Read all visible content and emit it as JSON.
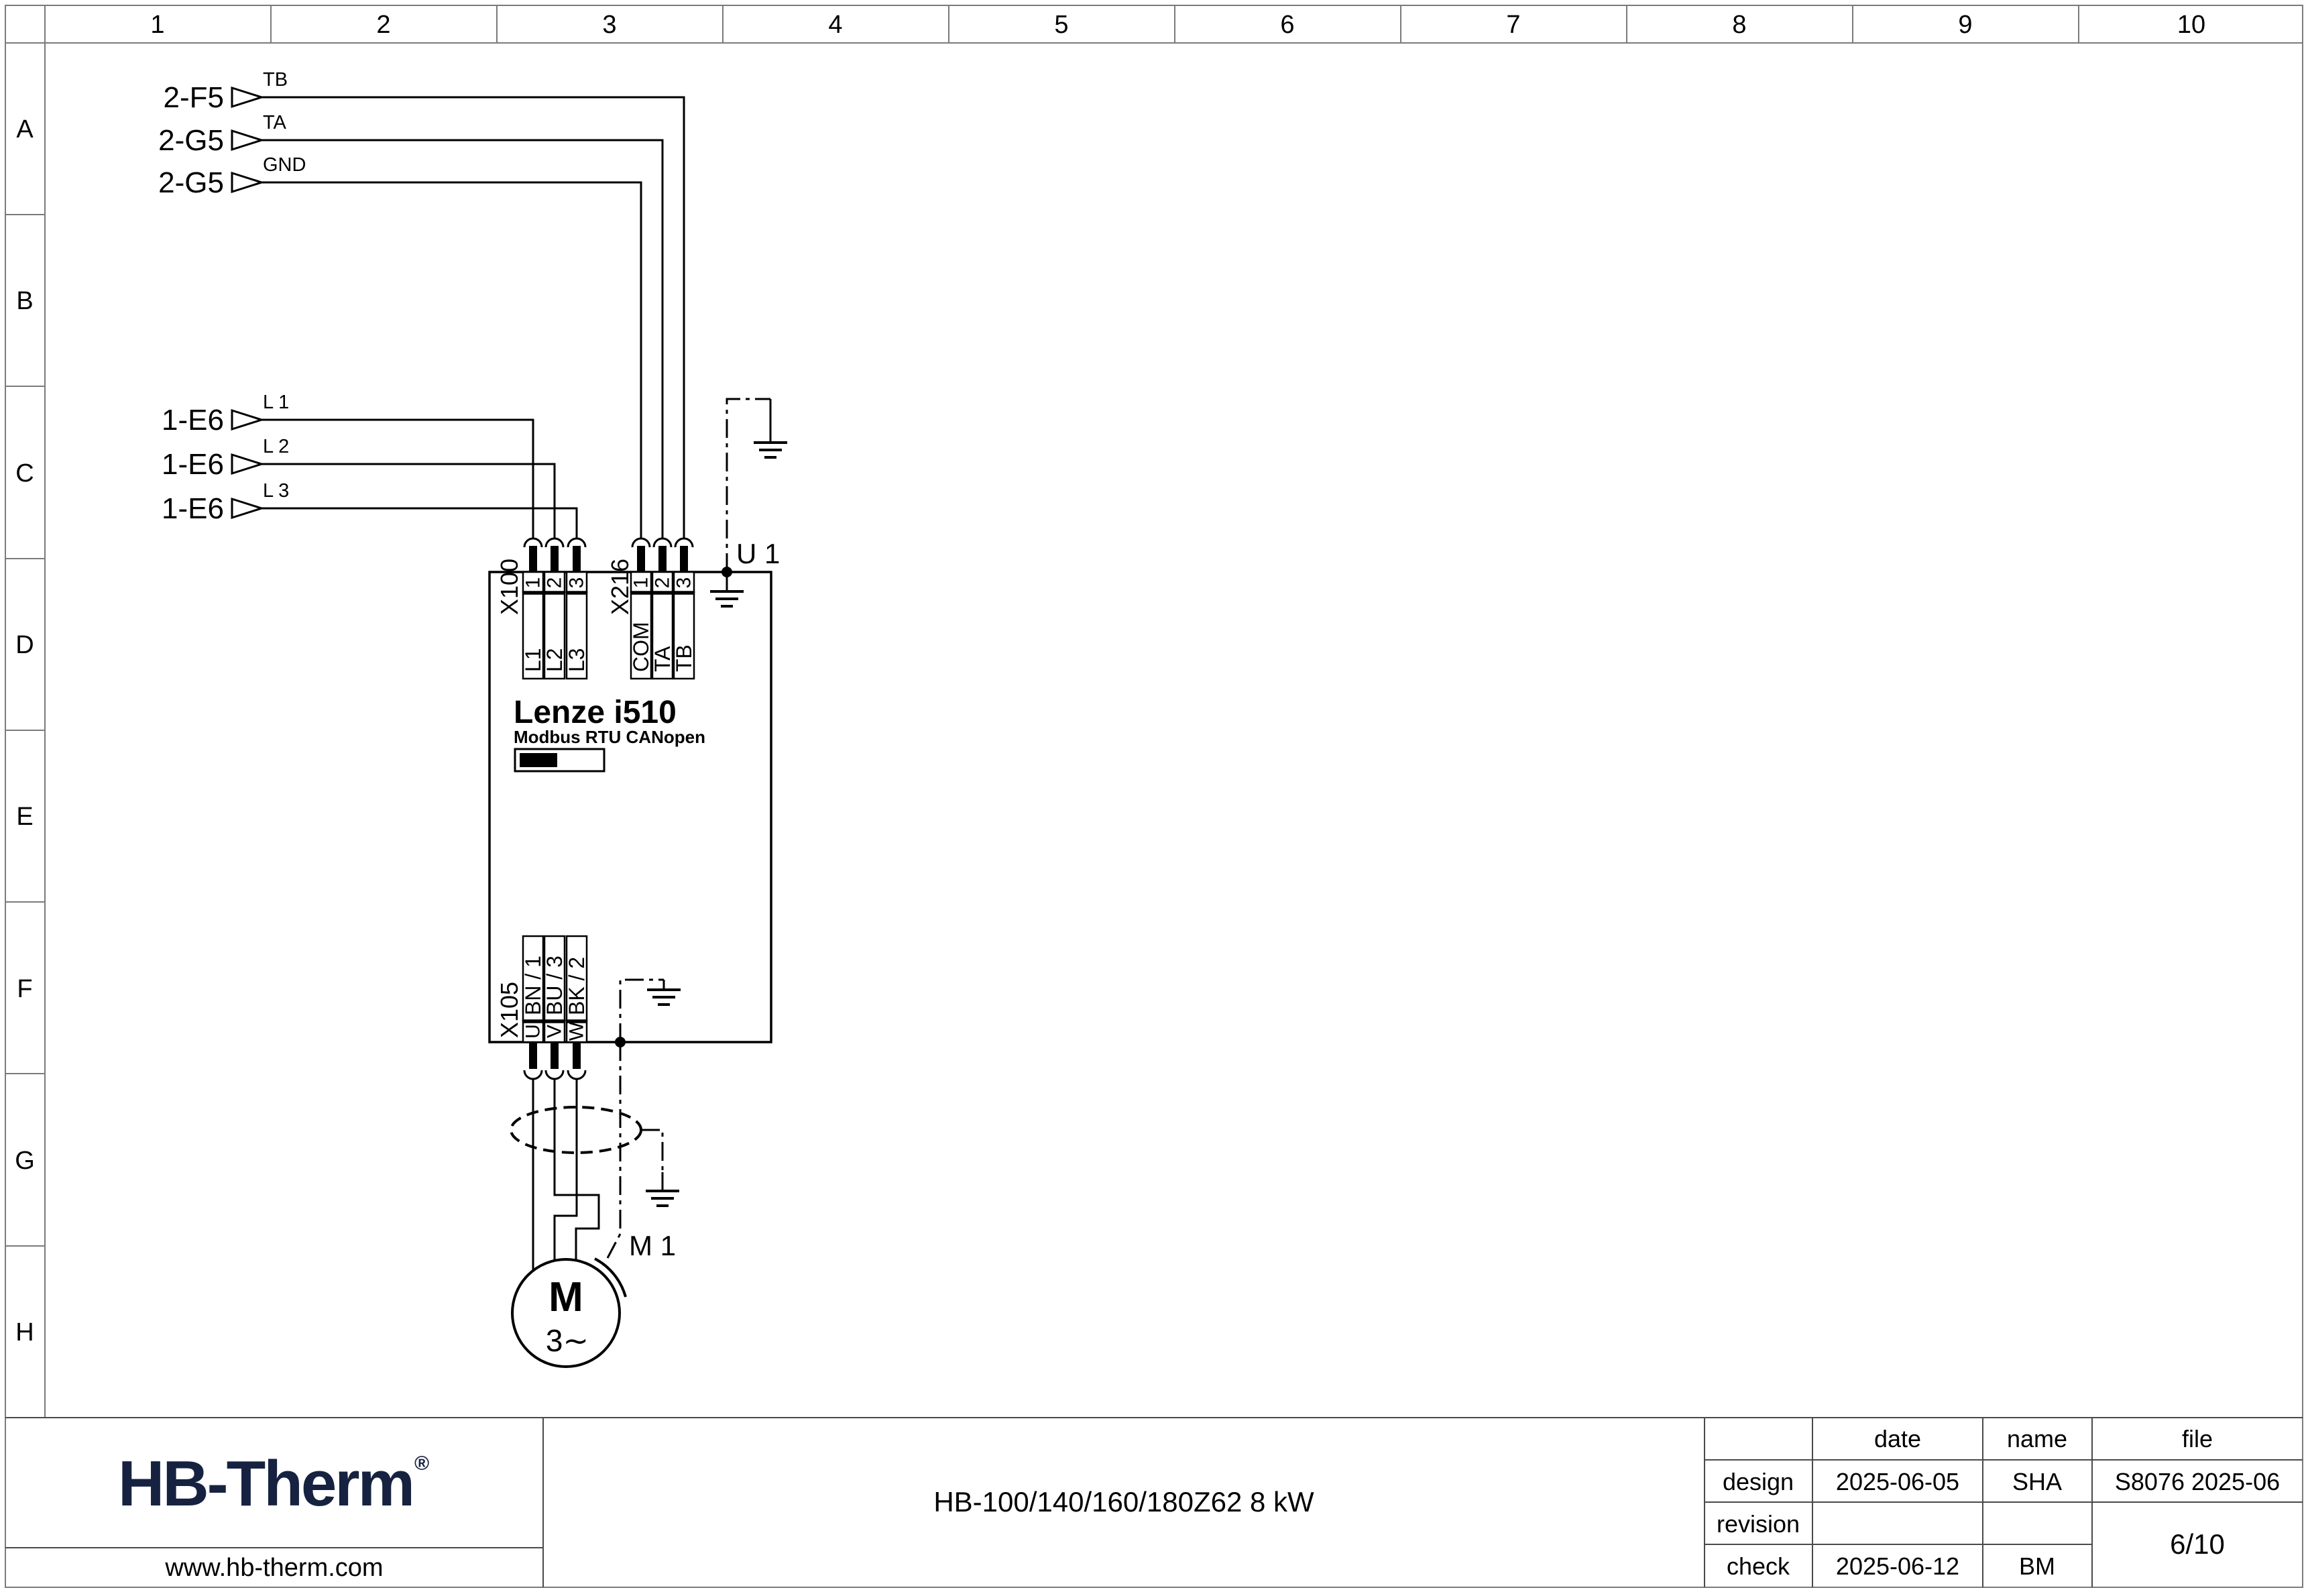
{
  "grid": {
    "cols": [
      "1",
      "2",
      "3",
      "4",
      "5",
      "6",
      "7",
      "8",
      "9",
      "10"
    ],
    "rows": [
      "A",
      "B",
      "C",
      "D",
      "E",
      "F",
      "G",
      "H"
    ]
  },
  "signals": {
    "top": [
      {
        "ref": "2-F5",
        "wire": "TB"
      },
      {
        "ref": "2-G5",
        "wire": "TA"
      },
      {
        "ref": "2-G5",
        "wire": "GND"
      }
    ],
    "mains": [
      {
        "ref": "1-E6",
        "wire": "L 1"
      },
      {
        "ref": "1-E6",
        "wire": "L 2"
      },
      {
        "ref": "1-E6",
        "wire": "L 3"
      }
    ]
  },
  "drive": {
    "designation": "U 1",
    "model": "Lenze i510",
    "comm": "Modbus RTU CANopen",
    "x100": {
      "label": "X100",
      "pins": [
        "1",
        "2",
        "3"
      ],
      "names": [
        "L1",
        "L2",
        "L3"
      ]
    },
    "x216": {
      "label": "X216",
      "pins": [
        "1",
        "2",
        "3"
      ],
      "names": [
        "COM",
        "TA",
        "TB"
      ]
    },
    "x105": {
      "label": "X105",
      "pins": [
        "U",
        "V",
        "W"
      ],
      "names": [
        "BN / 1",
        "BU / 3",
        "BK / 2"
      ]
    }
  },
  "motor": {
    "designation": "M 1",
    "letter": "M",
    "phases": "3∼"
  },
  "title_block": {
    "logo_text": "HB-Therm",
    "logo_reg": "®",
    "website": "www.hb-therm.com",
    "doc_title": "HB-100/140/160/180Z62 8 kW",
    "col_date": "date",
    "col_name": "name",
    "col_file": "file",
    "design_label": "design",
    "design_date": "2025-06-05",
    "design_name": "SHA",
    "design_file": "S8076 2025-06",
    "revision_label": "revision",
    "check_label": "check",
    "check_date": "2025-06-12",
    "check_name": "BM",
    "page": "6/10"
  },
  "colors": {
    "logo_navy": "#162240"
  }
}
